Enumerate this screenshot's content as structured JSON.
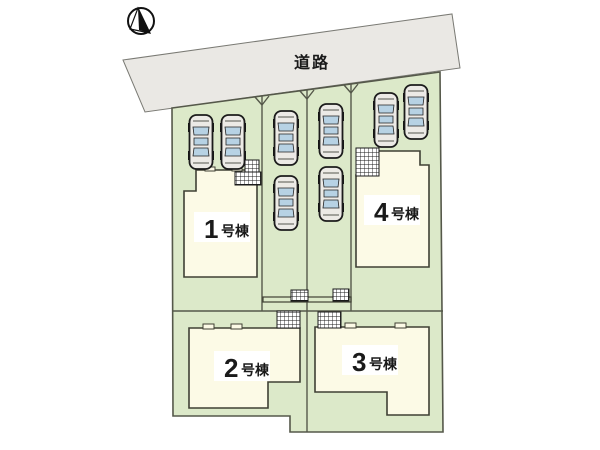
{
  "road": {
    "label": "道路",
    "fill": "#eae8e4",
    "edge_color": "#7a7a74"
  },
  "compass": {
    "icon": "north-arrow"
  },
  "site": {
    "land_fill": "#dce9c9",
    "boundary_color": "#55584a",
    "building_fill": "#fcfae6",
    "building_edge": "#3f4034"
  },
  "buildings": [
    {
      "id": "b1",
      "number": "1",
      "suffix": "号棟"
    },
    {
      "id": "b2",
      "number": "2",
      "suffix": "号棟"
    },
    {
      "id": "b3",
      "number": "3",
      "suffix": "号棟"
    },
    {
      "id": "b4",
      "number": "4",
      "suffix": "号棟"
    }
  ],
  "cars": {
    "window_color": "#b7d2e4",
    "body_fill": "#eceae6",
    "positions": [
      {
        "x": 188,
        "y": 114
      },
      {
        "x": 220,
        "y": 114
      },
      {
        "x": 273,
        "y": 110
      },
      {
        "x": 273,
        "y": 175
      },
      {
        "x": 318,
        "y": 103
      },
      {
        "x": 318,
        "y": 166
      },
      {
        "x": 373,
        "y": 92
      },
      {
        "x": 403,
        "y": 84
      }
    ]
  }
}
